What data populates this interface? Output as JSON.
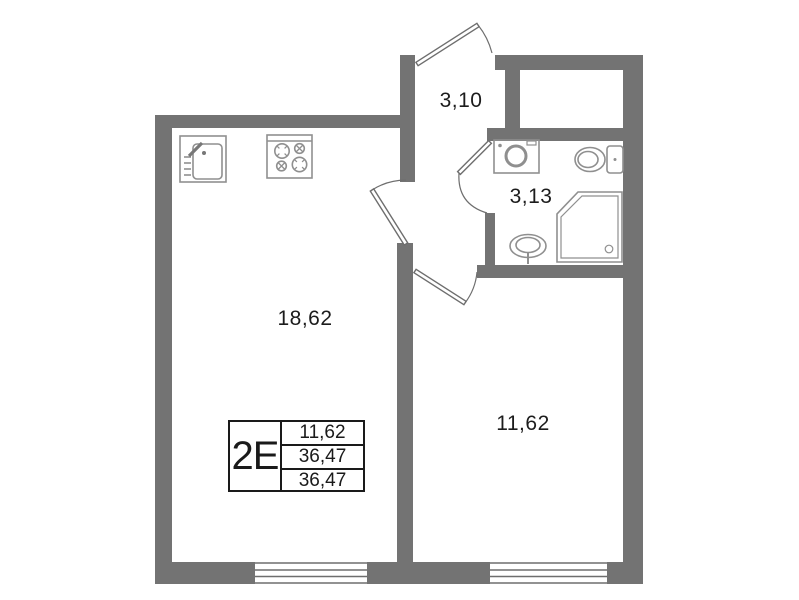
{
  "floorplan": {
    "rooms": [
      {
        "name": "kitchen-living-room",
        "area": "18,62"
      },
      {
        "name": "hallway",
        "area": "3,10"
      },
      {
        "name": "bathroom",
        "area": "3,13"
      },
      {
        "name": "bedroom",
        "area": "11,62"
      }
    ],
    "fixtures": [
      "kitchen-sink",
      "stove",
      "washing-machine",
      "toilet",
      "wash-basin",
      "shower-cabin"
    ],
    "doors": [
      "entrance-door",
      "kitchen-door",
      "bathroom-door",
      "bedroom-door"
    ],
    "windows": [
      "kitchen-window",
      "bedroom-window"
    ],
    "info_table": {
      "unit_label": "2E",
      "rows": [
        "11,62",
        "36,47",
        "36,47"
      ]
    },
    "colors": {
      "wall": "#737373",
      "door_window_line": "#6e6e6e",
      "fixture_line": "#8f8f8f",
      "text": "#1c1c1c",
      "background": "#ffffff"
    }
  }
}
